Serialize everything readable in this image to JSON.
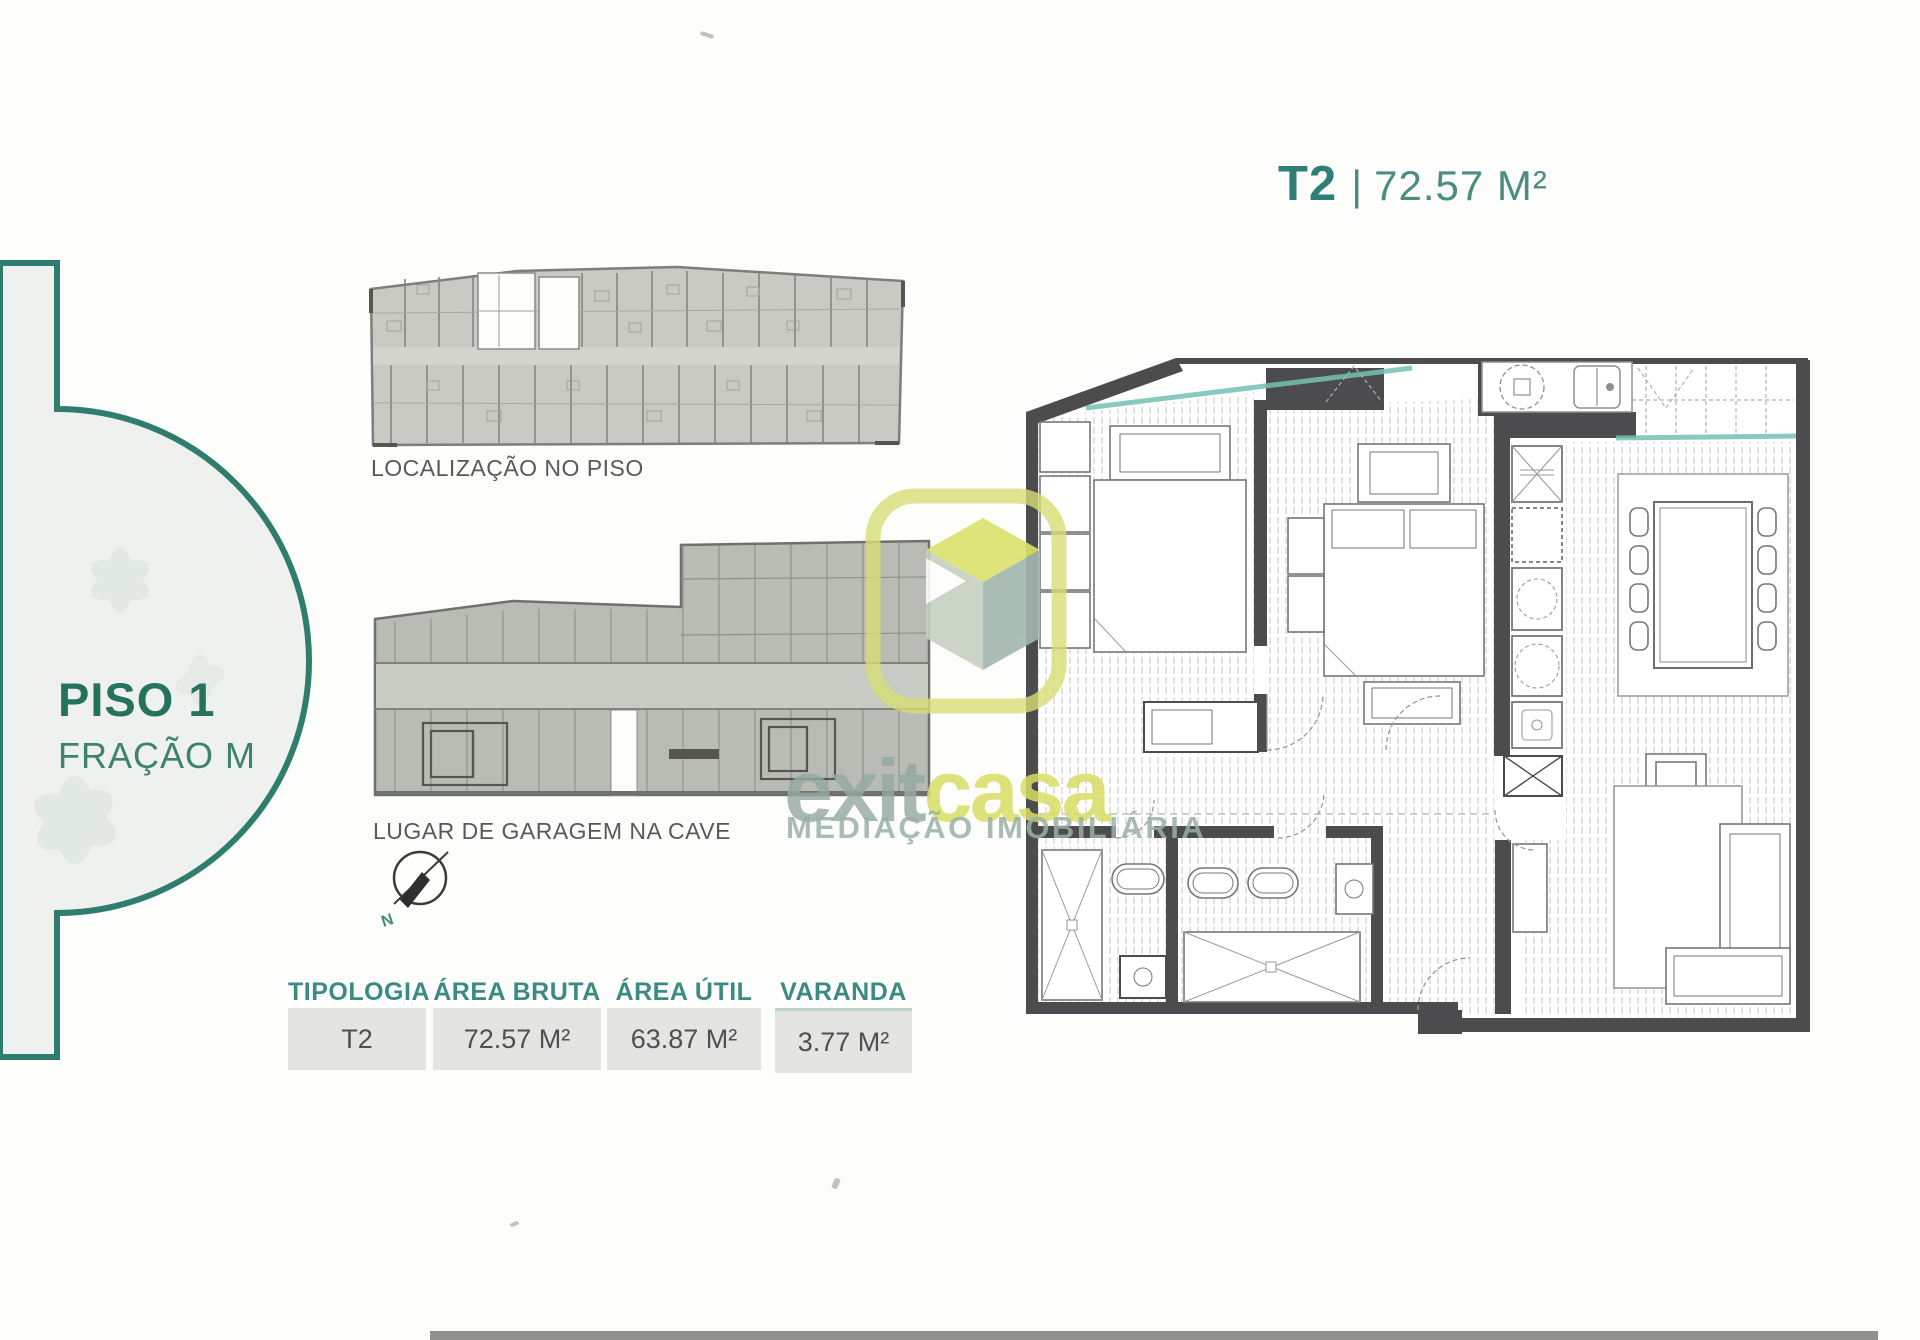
{
  "header": {
    "unit_type": "T2",
    "separator": "|",
    "gross_area": "72.57 M²"
  },
  "badge": {
    "floor": "PISO 1",
    "fraction": "FRAÇÃO M"
  },
  "plans": {
    "location_label": "LOCALIZAÇÃO NO PISO",
    "garage_label": "LUGAR DE GARAGEM NA CAVE",
    "compass_north": "N"
  },
  "area_table": {
    "headers": [
      "TIPOLOGIA",
      "ÁREA BRUTA",
      "ÁREA ÚTIL",
      "VARANDA"
    ],
    "row": [
      "T2",
      "72.57 M²",
      "63.87 M²",
      "3.77 M²"
    ]
  },
  "watermark": {
    "brand_exit": "exit",
    "brand_casa": "casa",
    "tagline": "MEDIAÇÃO IMOBILIÁRIA"
  },
  "colors": {
    "teal_dark": "#2e7d6d",
    "teal_text": "#4a8d82",
    "table_header_teal": "#3c8b81",
    "wall_dark": "#4c4c4e",
    "plan_accent_teal": "#74c3b1",
    "logo_yellow_green": "#d7dd64",
    "logo_sage": "#9ab1a7",
    "value_box_bg": "#e4e5e2"
  }
}
